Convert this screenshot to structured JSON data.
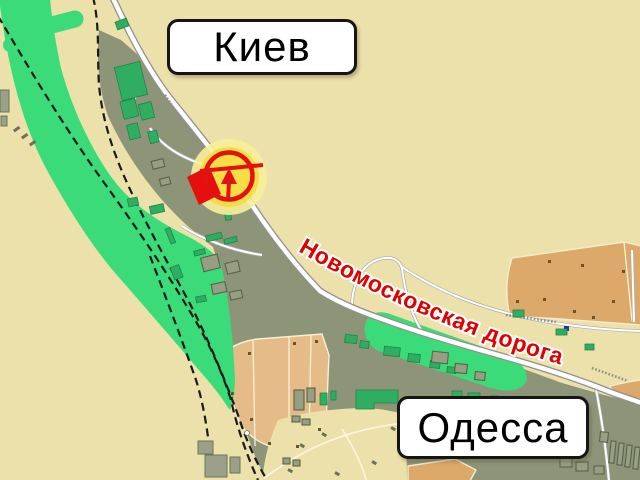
{
  "map": {
    "city_signs": [
      {
        "label": "Киев"
      },
      {
        "label": "Одесса"
      }
    ],
    "road_label": "Новомосковская дорога",
    "marker": {
      "kind": "destination-marker",
      "icon": "circle-with-arrow"
    },
    "colors": {
      "beige": "#EDE1AB",
      "olive": "#8D9478",
      "greenway": "#3BDB7A",
      "building_green": "#2FAD63",
      "allotment_tan": "#E5BC87",
      "field_orange": "#DCA96B",
      "road_white": "#FFFFFF",
      "road_casing": "#919191",
      "railway_black": "#1A1A1A",
      "label_red": "#E00000",
      "marker_red": "#E31212",
      "marker_yellow": "#F7DC42",
      "halo_yellow": "#F6EF9A",
      "sign_bg": "#FFFFFF",
      "sign_border": "#151515"
    }
  }
}
